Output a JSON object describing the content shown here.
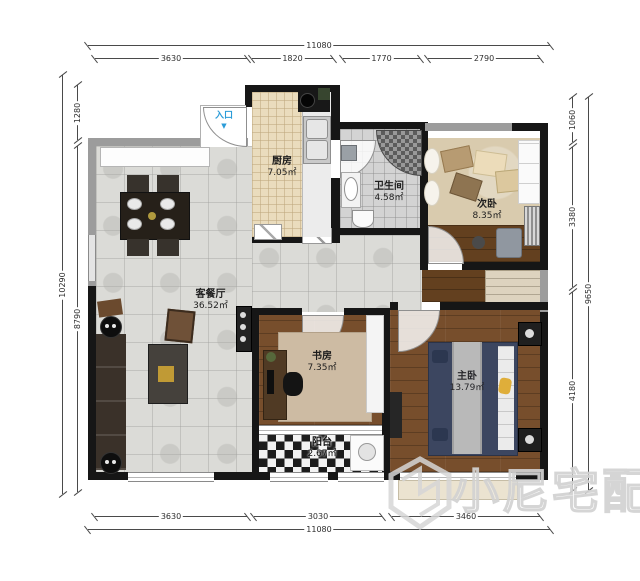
{
  "dims": {
    "top_total": "11080",
    "top_segs": [
      "3630",
      "1820",
      "1770",
      "2790"
    ],
    "bottom_segs": [
      "3630",
      "3030",
      "3460"
    ],
    "bottom_total": "11080",
    "left_outer": "10290",
    "left_segs": [
      "1280",
      "8790"
    ],
    "right_outer": "9650",
    "right_segs": [
      "1060",
      "3380",
      "4180"
    ]
  },
  "rooms": {
    "kitchen": {
      "name": "厨房",
      "area": "7.05㎡"
    },
    "bath": {
      "name": "卫生间",
      "area": "4.58㎡"
    },
    "bed2": {
      "name": "次卧",
      "area": "8.35㎡"
    },
    "living": {
      "name": "客餐厅",
      "area": "36.52㎡"
    },
    "study": {
      "name": "书房",
      "area": "7.35㎡"
    },
    "balcony": {
      "name": "阳台",
      "area": "2.67㎡"
    },
    "master": {
      "name": "主卧",
      "area": "13.79㎡"
    }
  },
  "entrance": {
    "label": "入口",
    "arrow": "▼"
  },
  "watermark": {
    "text": "小尼宅配"
  },
  "colors": {
    "wall": "#161616",
    "wall_gray": "#9c9c9c",
    "entrance_blue": "#2b9cd8",
    "kitchen_floor": "#eadcbd",
    "wood_master": "#774e2c",
    "bed_navy": "#3c4660",
    "accent_gold": "#dfae3a"
  }
}
